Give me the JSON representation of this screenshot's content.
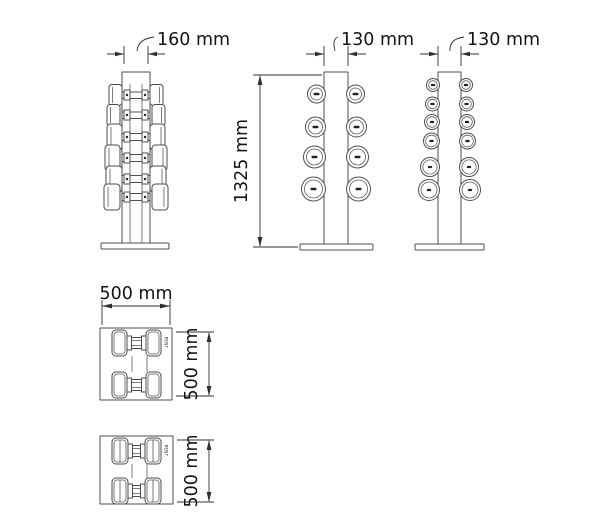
{
  "colors": {
    "background": "#ffffff",
    "drawing_line": "#4d4d4d",
    "dimension_line": "#2f2f2f",
    "dimension_text": "#141414"
  },
  "views": {
    "front": {
      "width_dim": "160 mm"
    },
    "side_large_dumbbells": {
      "width_dim": "130 mm",
      "height_dim": "1325 mm"
    },
    "side_small_dumbbells": {
      "width_dim": "130 mm"
    },
    "top_large_dumbbells": {
      "width_dim": "500 mm",
      "depth_dim": "500 mm",
      "brand": "PENT."
    },
    "top_small_dumbbells": {
      "depth_dim": "500 mm",
      "brand": "PENT."
    }
  }
}
